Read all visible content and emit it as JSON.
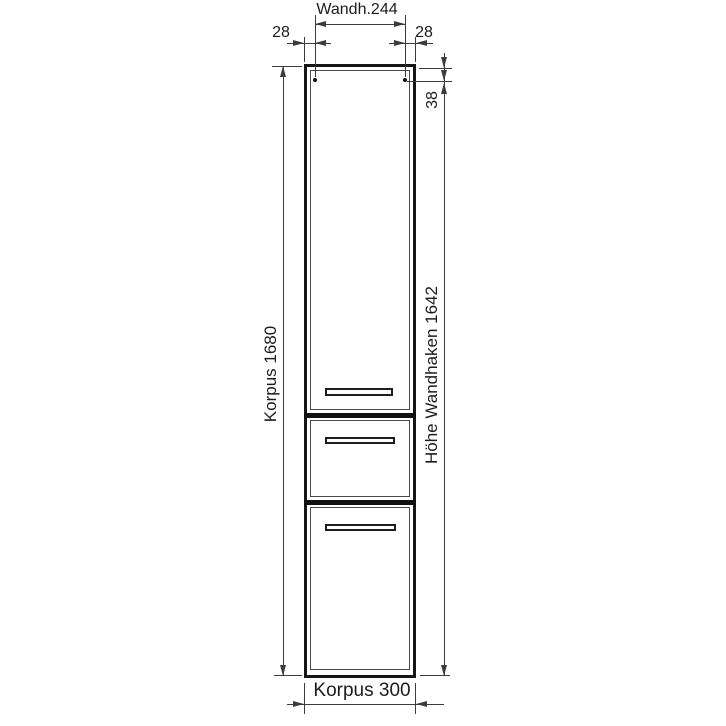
{
  "diagram": {
    "kind": "furniture-dimension-drawing",
    "labels": {
      "top_width": "Wandh.244",
      "top_left_offset": "28",
      "top_right_offset": "28",
      "body_height": "Korpus 1680",
      "hook_top_offset": "38",
      "hook_height": "Höhe Wandhaken 1642",
      "body_width": "Korpus 300"
    },
    "measurements": {
      "wandhaken_width": 244,
      "side_offset_left": 28,
      "side_offset_right": 28,
      "korpus_height": 1680,
      "hook_top_offset": 38,
      "hoehe_wandhaken": 1642,
      "korpus_width": 300
    },
    "colors": {
      "background": "#ffffff",
      "outline": "#161616",
      "dimension_lines": "#3c3c3c",
      "panel_lines": "#4a4a4a",
      "text": "#1c1c1c"
    }
  }
}
